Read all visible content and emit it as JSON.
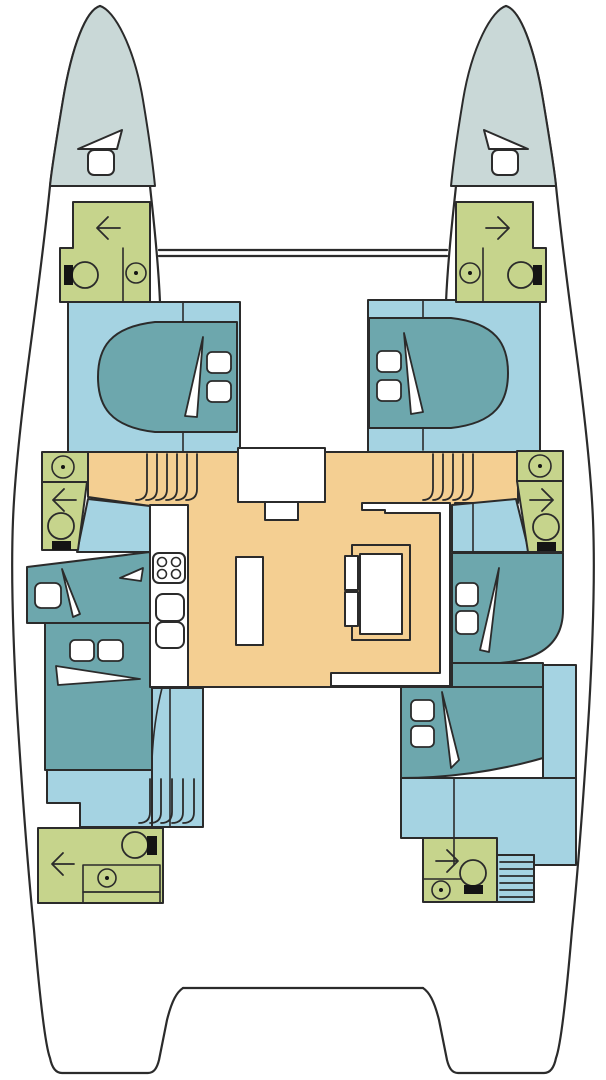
{
  "page": {
    "title": "Catamaran yacht accommodation deck plan",
    "view": "top-down floor plan, bow at top"
  },
  "colors": {
    "outline": "#2b2b2b",
    "white": "#ffffff",
    "black": "#141414",
    "bow_peak": "#c9d8d7",
    "cabin_floor": "#a5d3e2",
    "bed": "#6da7ad",
    "bathroom": "#c6d48c",
    "salon_floor": "#f4cf92"
  },
  "inventory": {
    "hull_count": 2,
    "cabins": [
      "port-bow-peak-berth",
      "starboard-bow-peak-berth",
      "port-forward-cabin",
      "starboard-forward-cabin",
      "port-mid-berth",
      "starboard-mid-cabin",
      "port-aft-cabin",
      "starboard-aft-cabin"
    ],
    "bathrooms": [
      "port-forward-head",
      "starboard-forward-head",
      "port-mid-head",
      "starboard-mid-head",
      "port-aft-head",
      "starboard-aft-head"
    ],
    "bathroom_fixtures": [
      "toilet",
      "washbasin",
      "door-swing-arrow"
    ],
    "salon": [
      "galley-counter",
      "stove",
      "galley-sinks",
      "island-counter",
      "dinette-settee",
      "dinette-table",
      "dinette-seats",
      "forward-door",
      "forward-door-step"
    ],
    "stairs": [
      "port-forward-companionway",
      "starboard-forward-companionway",
      "port-aft-companionway",
      "starboard-aft-companionway"
    ],
    "structure": [
      "forward-crossbeam",
      "aft-crossbeam",
      "bow-hatch",
      "bow-cushion"
    ]
  }
}
